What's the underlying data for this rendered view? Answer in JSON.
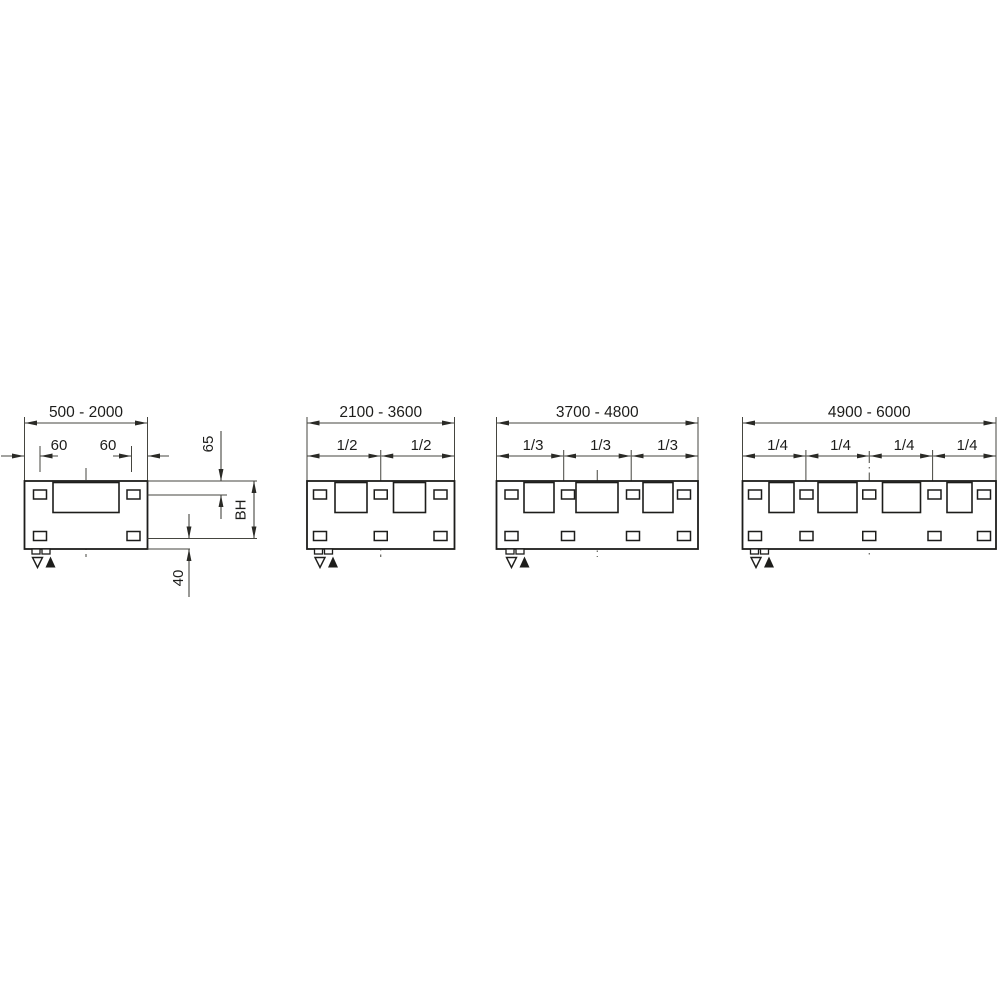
{
  "drawing": {
    "description": "Mounting dimension drawing with four panel width variants",
    "colors": {
      "background": "#ffffff",
      "line": "#45453f",
      "shape": "#1d1d1b"
    },
    "figures": [
      {
        "name": "width-500-2000",
        "width_range": "500 - 2000",
        "segment_labels": [
          "60",
          "60"
        ],
        "vertical_labels": {
          "top": "65",
          "middle": "BH",
          "bottom": "40"
        },
        "symbols": {
          "open_triangle": "▽",
          "filled_triangle": "▲"
        }
      },
      {
        "name": "width-2100-3600",
        "width_range": "2100 - 3600",
        "segment_labels": [
          "1/2",
          "1/2"
        ],
        "symbols": {
          "open_triangle": "▽",
          "filled_triangle": "▲"
        }
      },
      {
        "name": "width-3700-4800",
        "width_range": "3700 - 4800",
        "segment_labels": [
          "1/3",
          "1/3",
          "1/3"
        ],
        "symbols": {
          "open_triangle": "▽",
          "filled_triangle": "▲"
        }
      },
      {
        "name": "width-4900-6000",
        "width_range": "4900 - 6000",
        "segment_labels": [
          "1/4",
          "1/4",
          "1/4",
          "1/4"
        ],
        "symbols": {
          "open_triangle": "▽",
          "filled_triangle": "▲"
        }
      }
    ]
  }
}
